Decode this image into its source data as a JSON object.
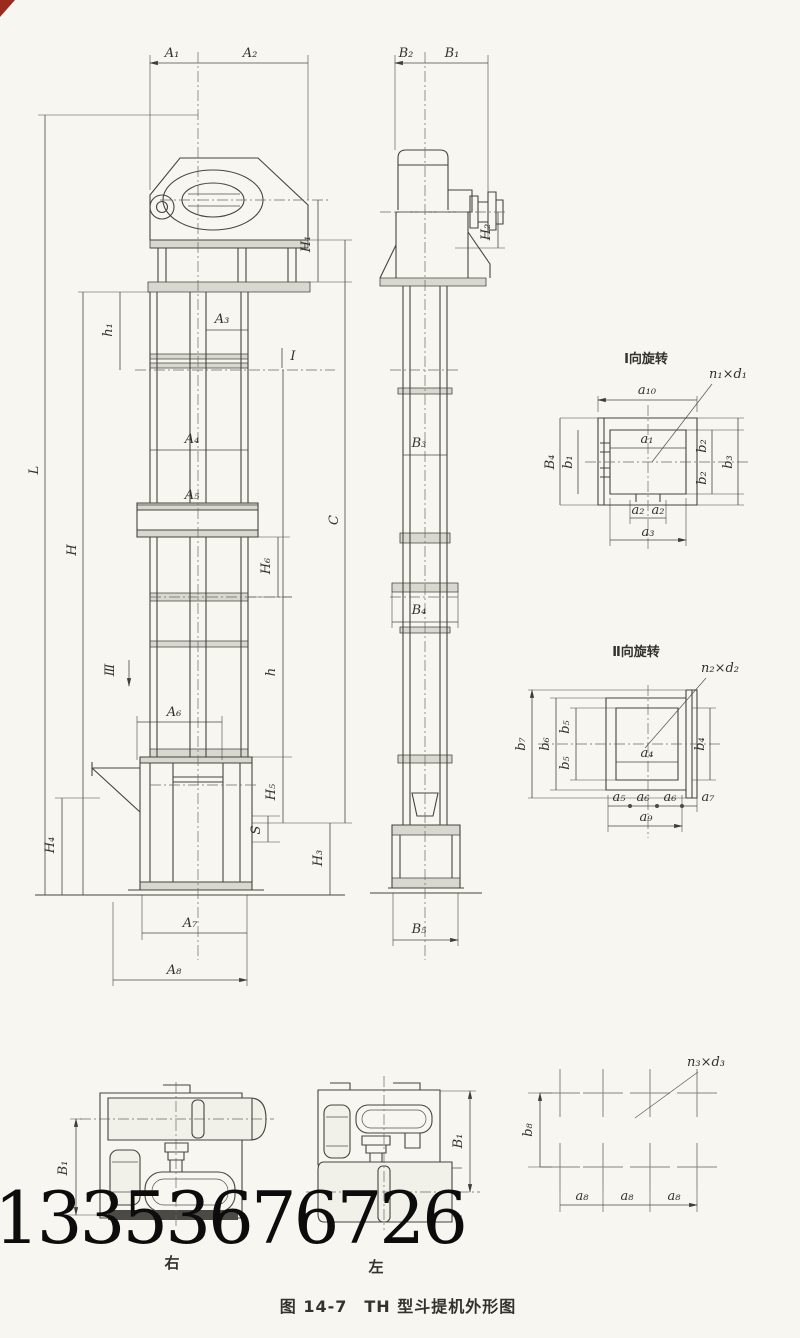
{
  "figure": {
    "caption": "图 14-7　TH 型斗提机外形图",
    "watermark_phone": "13353676726",
    "paper_color": "#f7f6f1",
    "ink_color": "#45443e"
  },
  "labels": {
    "front": {
      "A1": "A₁",
      "A2": "A₂",
      "A3": "A₃",
      "A4": "A₄",
      "A5": "A₅",
      "A6": "A₆",
      "A7": "A₇",
      "A8": "A₈",
      "L": "L",
      "H": "H",
      "h1": "h₁",
      "h": "h",
      "H1": "H₁",
      "H3": "H₃",
      "H4": "H₄",
      "H5": "H₅",
      "H6": "H₆",
      "C": "C",
      "S": "S",
      "view_I": "Ⅰ",
      "view_III": "Ⅲ"
    },
    "side": {
      "B1": "B₁",
      "B2": "B₂",
      "B3": "B₃",
      "B4": "B₄",
      "B5": "B₅",
      "H2": "H₂"
    },
    "detail_I": {
      "title": "Ⅰ向旋转",
      "holes": "n₁×d₁",
      "a10": "a₁₀",
      "a1": "a₁",
      "B4": "B₄",
      "b1": "b₁",
      "b2_top": "b₂",
      "b2_bottom": "b₂",
      "b3": "b₃",
      "a2_left": "a₂",
      "a2_right": "a₂",
      "a3": "a₃"
    },
    "detail_II": {
      "title": "Ⅱ向旋转",
      "holes": "n₂×d₂",
      "b7": "b₇",
      "b6": "b₆",
      "b5_top": "b₅",
      "b5_bottom": "b₅",
      "b4": "b₄",
      "a4": "a₄",
      "a5": "a₅",
      "a6_left": "a₆",
      "a6_right": "a₆",
      "a7": "a₇",
      "a9": "a₉"
    },
    "hole_pattern": {
      "holes": "n₃×d₃",
      "b8": "b₈",
      "a8_1": "a₈",
      "a8_2": "a₈",
      "a8_3": "a₈"
    },
    "plan_views": {
      "right_view": "右",
      "left_view": "左",
      "B1_right": "B₁",
      "B1_left": "B₁"
    }
  }
}
